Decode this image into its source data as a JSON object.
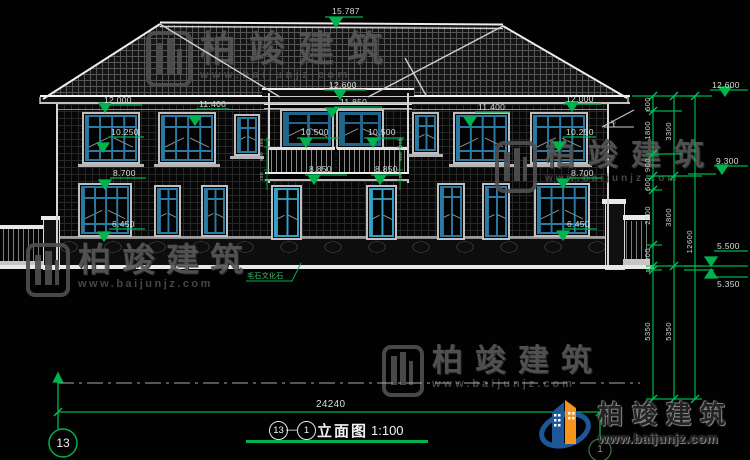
{
  "drawing": {
    "ridge_elev": "15.787",
    "center": {
      "eave": "12.600",
      "head": "11.850",
      "sill_left": "10.500",
      "sill_right": "10.500",
      "slab_left": "8.850",
      "slab_right": "8.850"
    },
    "left_wing": {
      "eave": "12.000",
      "head2": "11.400",
      "sill2": "10.250",
      "head1": "8.700",
      "sill1": "6.450"
    },
    "right_wing": {
      "eave": "12.000",
      "head2": "11.400",
      "sill2": "10.250",
      "head1": "8.700",
      "sill1": "6.450"
    },
    "right_levels": {
      "eave": "12.600",
      "mid": "9.300",
      "low_a": "5.500",
      "low_b": "5.350"
    },
    "chains": {
      "c1": [
        "600",
        "1800",
        "900",
        "600",
        "2300",
        "900",
        "150",
        "5350"
      ],
      "c2": [
        "3300",
        "3800",
        "5350"
      ],
      "c3": [
        "12600"
      ]
    },
    "balcony_dims": [
      "300",
      "900",
      "150"
    ],
    "slope_label": "45",
    "stone_label": "毛石文化石",
    "total_width": "24240"
  },
  "title_block": {
    "axis_bubble_left": "13",
    "axis_bubble_right": "1",
    "circle_a": "13",
    "dash": "—",
    "circle_b": "1",
    "name": "立面图",
    "scale": "1:100"
  },
  "watermark": {
    "brand": "柏竣建筑",
    "url": "www.baijunjz.com"
  },
  "logo": {
    "brand": "柏竣建筑",
    "url": "www.baijunjz.com"
  },
  "colors": {
    "dim_green": "#00b34d",
    "window_blue": "#2b7aa4",
    "logo_blue": "#1e5799",
    "logo_orange": "#f7941d"
  }
}
